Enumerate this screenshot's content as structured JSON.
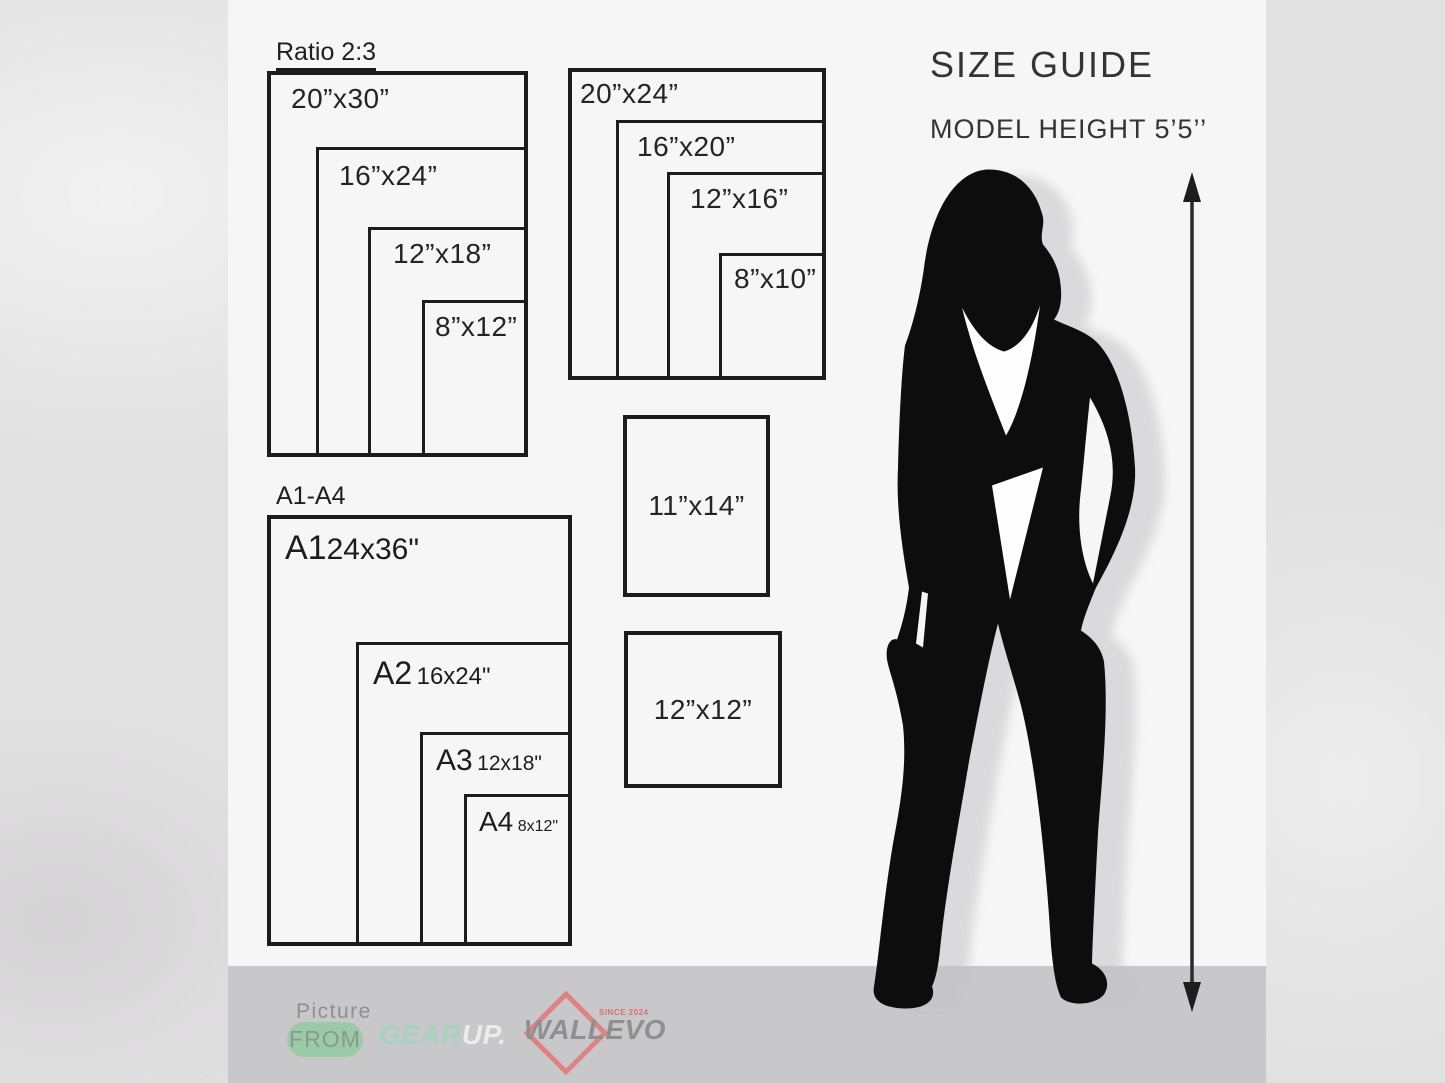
{
  "header": {
    "title": "SIZE GUIDE",
    "model_height": "MODEL HEIGHT 5’5’’"
  },
  "groups": {
    "ratio23": {
      "heading": "Ratio 2:3",
      "boxes": [
        {
          "label": "20”x30”"
        },
        {
          "label": "16”x24”"
        },
        {
          "label": "12”x18”"
        },
        {
          "label": "8”x12”"
        }
      ]
    },
    "ratio45": {
      "boxes": [
        {
          "label": "20”x24”"
        },
        {
          "label": "16”x20”"
        },
        {
          "label": "12”x16”"
        },
        {
          "label": "8”x10”"
        }
      ]
    },
    "aseries": {
      "heading": "A1-A4",
      "boxes": [
        {
          "name": "A1",
          "size": "24x36\""
        },
        {
          "name": "A2",
          "size": "16x24\""
        },
        {
          "name": "A3",
          "size": "12x18\""
        },
        {
          "name": "A4",
          "size": "8x12\""
        }
      ]
    },
    "singles": [
      {
        "label": "11”x14”"
      },
      {
        "label": "12”x12”"
      }
    ]
  },
  "footer": {
    "picture": {
      "line": "Picture",
      "badge": "FROM"
    },
    "gearup": {
      "part1": "GEAR",
      "part2": "UP."
    },
    "wallevo": {
      "name": "WALLEVO",
      "since": "SINCE 2024"
    }
  },
  "colors": {
    "panel": "#f7f6f6",
    "background": "#e2e1e2",
    "footer_band": "#c8c7c9",
    "box_border": "#1c1c1c",
    "text": "#242424",
    "from_pill_green": "#9bcba6",
    "gear_mint": "#a6d3bf",
    "gear_up_light": "#ecedea",
    "wallevo_gray": "#8f8f8f",
    "wallevo_red": "#de8383",
    "silhouette_black": "#0d0d0d"
  }
}
